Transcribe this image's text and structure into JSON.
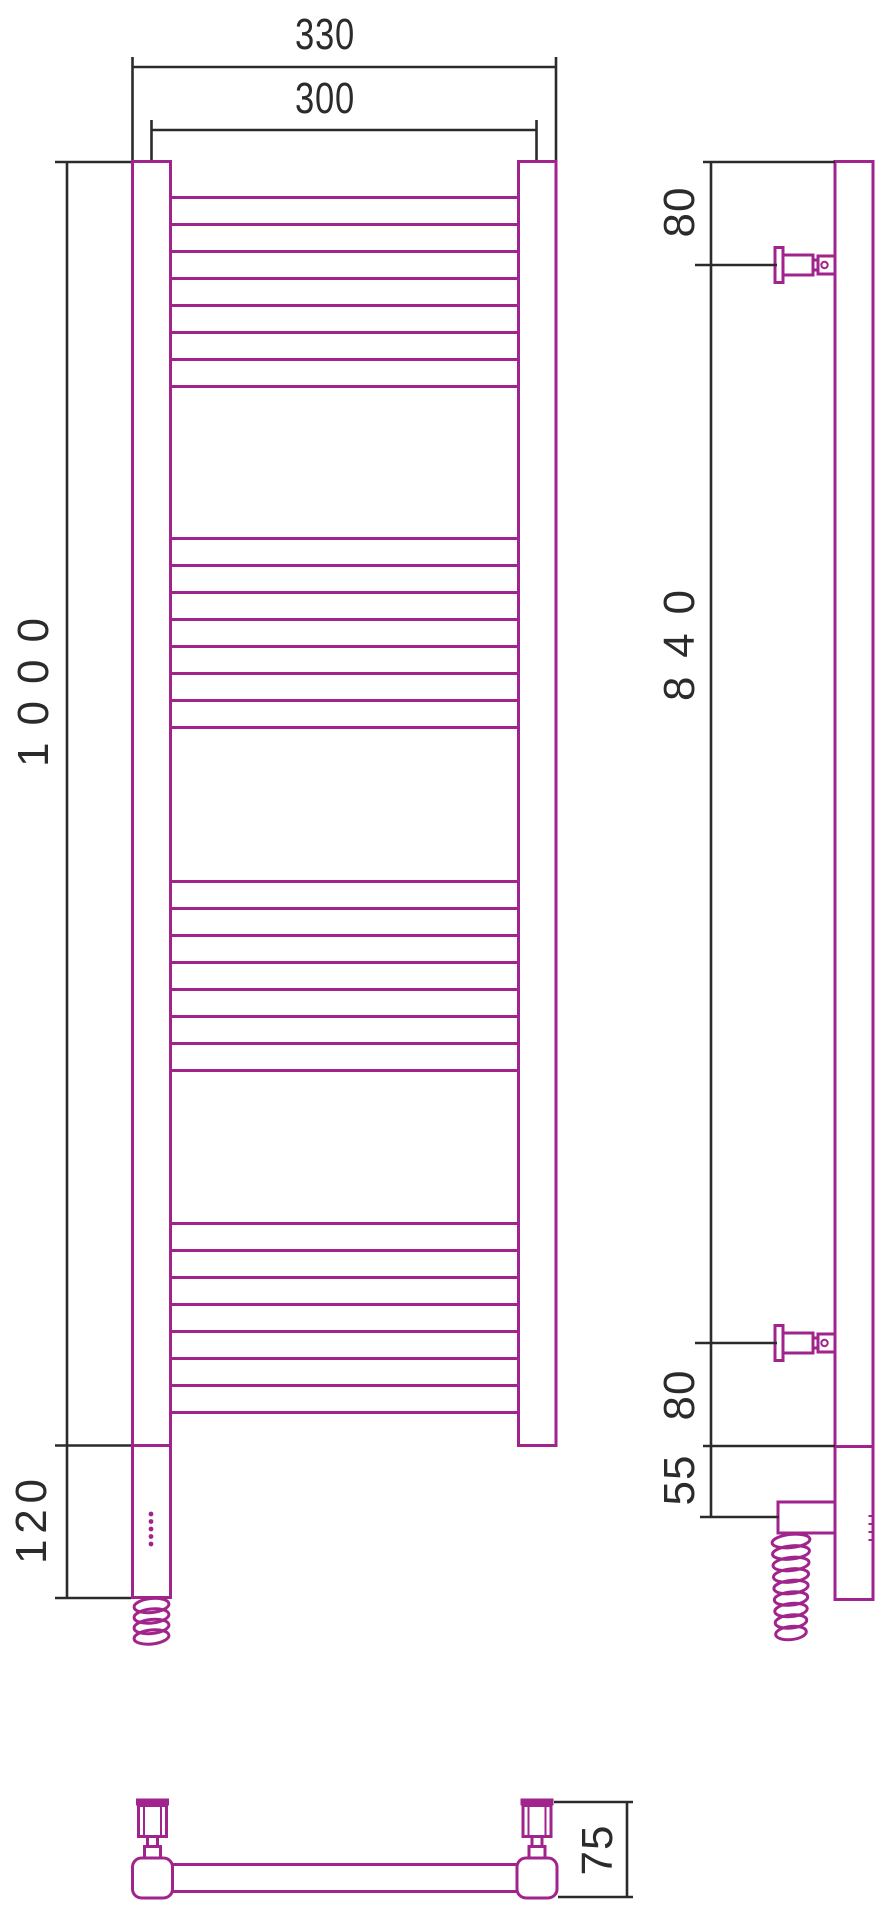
{
  "drawing": {
    "title": "Ladder towel radiator — dimensional drawing, three views",
    "background": "#ffffff",
    "outline_color": "#a1248c",
    "dimension_color": "#2b2b2b"
  },
  "front_view": {
    "width_overall": "330",
    "width_centers": "300",
    "height_overall": "1000",
    "heater_zone_height": "120",
    "rung_groups": 4,
    "rungs_per_group": 8,
    "rungs_total": 32,
    "led_dots": 5
  },
  "side_view": {
    "top_to_bracket": "80",
    "bracket_span": "840",
    "bracket_to_bottom": "80",
    "bottom_to_heater": "55",
    "brackets": 2
  },
  "bottom_view": {
    "depth_to_wall": "75"
  },
  "geometry": {
    "rungs": {
      "x1": 170.5,
      "x2": 518.5,
      "starts": [
        197.5,
        538.5,
        881.5,
        1223.5
      ],
      "step": 27,
      "count": 8
    },
    "front_leds": {
      "cx": 151,
      "y0": 1514,
      "step": 7.5,
      "count": 5,
      "r": 2.4
    },
    "side_leds": {
      "x1": 868.5,
      "x2": 874.5,
      "y0": 1516,
      "step": 8,
      "count": 4
    },
    "front_coil": {
      "cx": 151.5,
      "y0": 1605.5,
      "step": 10.5,
      "count": 4,
      "rx": 17.5,
      "ry": 7,
      "tilt": -6
    },
    "side_coil": {
      "cx": 791,
      "y0": 1541,
      "step": 11.5,
      "count": 9,
      "rx0": 19,
      "drx": -0.45,
      "ry": 6.6,
      "tilt": -6
    }
  }
}
